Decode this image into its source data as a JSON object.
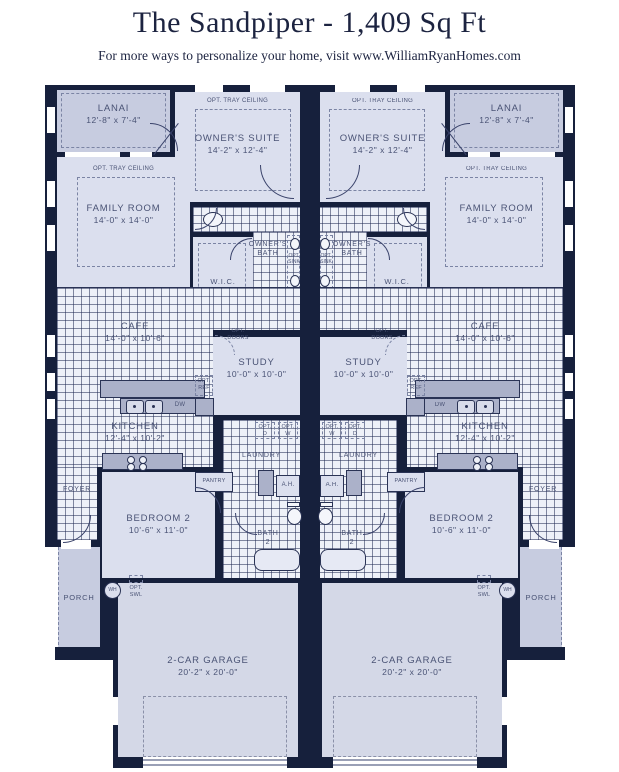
{
  "header": {
    "title": "The Sandpiper - 1,409 Sq Ft",
    "subtitle": "For more ways to personalize your home, visit www.WilliamRyanHomes.com"
  },
  "unit": {
    "lanai": {
      "name": "LANAI",
      "dims": "12'-8\" x 7'-4\""
    },
    "owners_suite": {
      "tray": "OPT. TRAY CEILING",
      "name": "OWNER'S SUITE",
      "dims": "14'-2\" x 12'-4\""
    },
    "family_room": {
      "tray": "OPT. TRAY CEILING",
      "name": "FAMILY ROOM",
      "dims": "14'-0\" x 14'-0\""
    },
    "owners_bath": {
      "line1": "OWNER'S",
      "line2": "BATH"
    },
    "opt_sink": {
      "line1": "OPT.",
      "line2": "SINK"
    },
    "wic": {
      "name": "W.I.C."
    },
    "cafe": {
      "name": "CAFE",
      "dims": "14'-0\" x 10'-6\""
    },
    "opt_doors": {
      "line1": "OPT.",
      "line2": "DOORS"
    },
    "study": {
      "name": "STUDY",
      "dims": "10'-0\" x 10'-0\""
    },
    "opt_ref": {
      "line1": "OPT.",
      "line2": "REF"
    },
    "kitchen": {
      "name": "KITCHEN",
      "dims": "12'-4\" x 10'-2\"",
      "dw": "DW"
    },
    "pantry": {
      "name": "PANTRY"
    },
    "laundry": {
      "name": "LAUNDRY"
    },
    "opt_d": {
      "line1": "OPT.",
      "line2": "D"
    },
    "opt_w": {
      "line1": "OPT.",
      "line2": "W"
    },
    "ah": {
      "name": "A.H."
    },
    "bath2": {
      "line1": "BATH",
      "line2": "2"
    },
    "bedroom2": {
      "name": "BEDROOM 2",
      "dims": "10'-6\" x 11'-0\""
    },
    "foyer": {
      "name": "FOYER"
    },
    "porch": {
      "name": "PORCH"
    },
    "garage": {
      "name": "2-CAR GARAGE",
      "dims": "20'-2\" x 20'-0\""
    },
    "wh": {
      "name": "WH"
    },
    "opt_swl": {
      "line1": "OPT.",
      "line2": "SWL"
    }
  },
  "colors": {
    "wall": "#16203c",
    "room_fill": "#dbdfee",
    "outdoor_fill": "#c7cce0",
    "tile_fill": "#eef1f8",
    "tile_line": "#2a3355",
    "counter": "#abb1c9",
    "label_text": "#4a5375",
    "title_text": "#1c2340"
  }
}
